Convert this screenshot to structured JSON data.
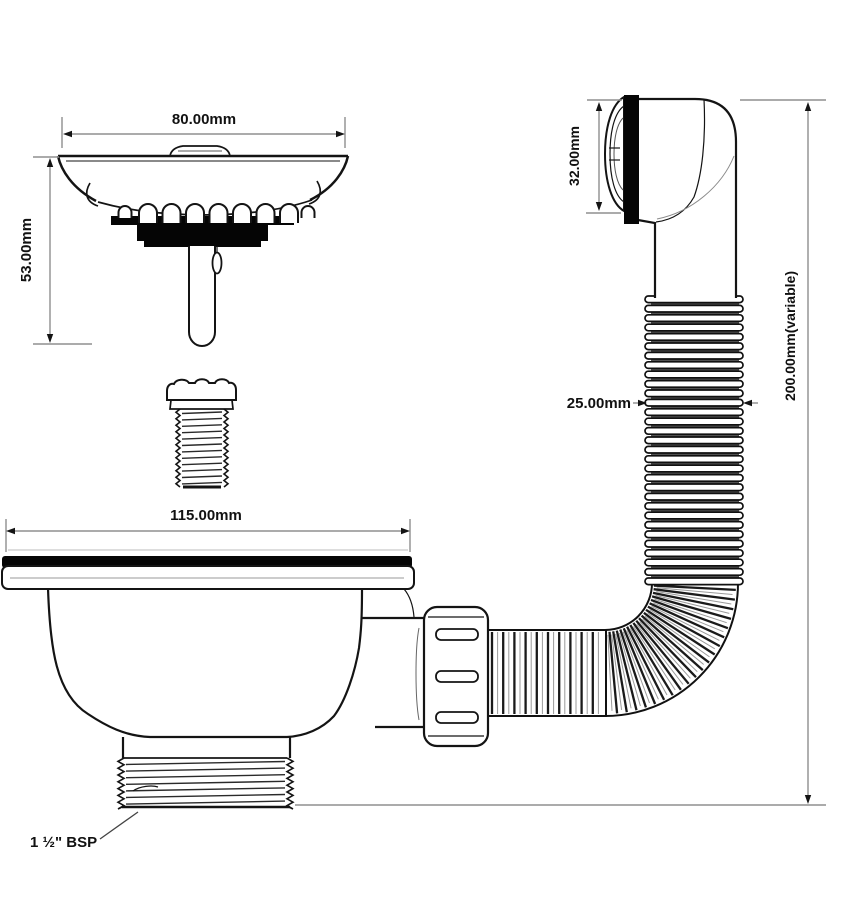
{
  "figure": {
    "type": "technical-drawing",
    "subject": "Kitchen sink basket strainer waste with flexible overflow kit"
  },
  "labels": {
    "strainer_diameter": "80.00mm",
    "strainer_height": "53.00mm",
    "flange_diameter": "115.00mm",
    "overflow_height": "32.00mm",
    "hose_diameter": "25.00mm",
    "overall_length": "200.00mm(variable)",
    "outlet_thread": "1 ½\" BSP"
  },
  "colors": {
    "line": "#141414",
    "dimension": "#8f8f8f",
    "seal": "#050505",
    "background": "#ffffff",
    "hose_gap": "#4f4f4f"
  }
}
